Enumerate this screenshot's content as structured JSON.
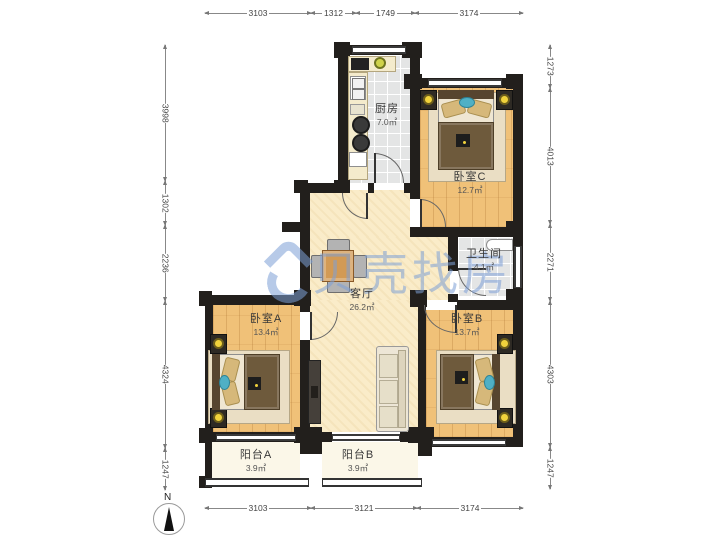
{
  "plan": {
    "watermark": "贝壳找房",
    "compass_label": "N",
    "rooms": [
      {
        "id": "kitchen",
        "name": "厨房",
        "area": "7.0㎡"
      },
      {
        "id": "bedroomC",
        "name": "卧室C",
        "area": "12.7㎡"
      },
      {
        "id": "bathroom",
        "name": "卫生间",
        "area": "4.1㎡"
      },
      {
        "id": "living",
        "name": "客厅",
        "area": "26.2㎡"
      },
      {
        "id": "bedroomA",
        "name": "卧室A",
        "area": "13.4㎡"
      },
      {
        "id": "bedroomB",
        "name": "卧室B",
        "area": "13.7㎡"
      },
      {
        "id": "balconyA",
        "name": "阳台A",
        "area": "3.9㎡"
      },
      {
        "id": "balconyB",
        "name": "阳台B",
        "area": "3.9㎡"
      }
    ]
  },
  "dimensions": {
    "top": [
      "3103",
      "1312",
      "1749",
      "3174"
    ],
    "bottom": [
      "3103",
      "3121",
      "3174"
    ],
    "left": [
      "3998",
      "1302",
      "2236",
      "4324",
      "1247"
    ],
    "right": [
      "1273",
      "4013",
      "2271",
      "4303",
      "1247"
    ]
  },
  "colors": {
    "wall": "#221f1c",
    "wood": "#f0c178",
    "living": "#faecc9",
    "tile": "#e4e5e5",
    "balcony": "#fbf7e8",
    "wm": "#7da0d7",
    "lamp": "#f0d23c",
    "teal": "#4fb0c5"
  }
}
